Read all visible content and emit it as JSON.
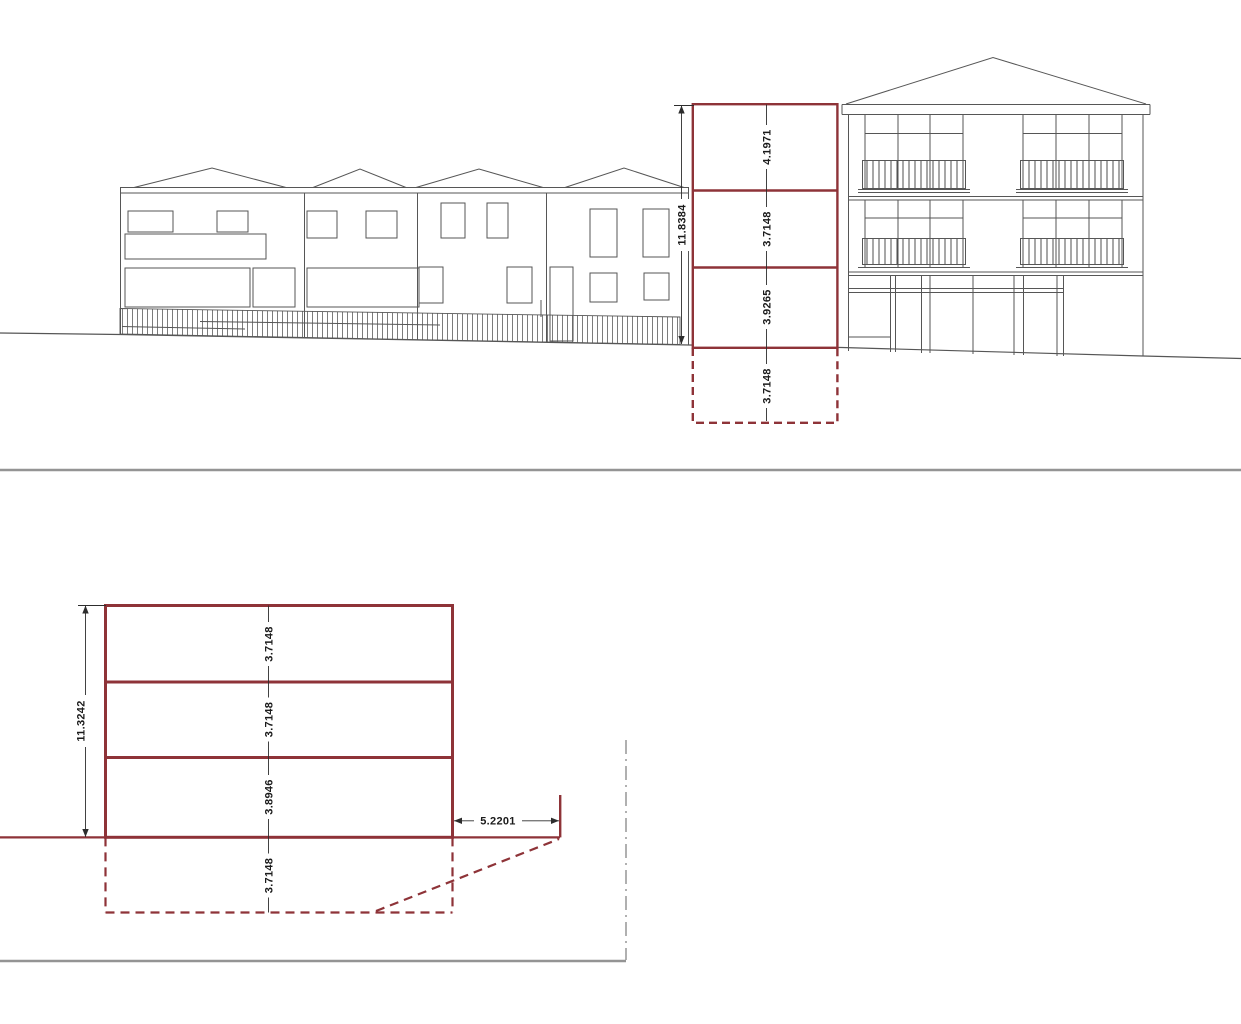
{
  "drawing": {
    "upper_elevation": {
      "description": "street elevation with proposed building outline",
      "total_height": "11.8384",
      "floor_heights": [
        "4.1971",
        "3.7148",
        "3.9265"
      ],
      "basement_height": "3.7148"
    },
    "lower_section": {
      "description": "section through proposed building",
      "total_height": "11.3242",
      "floor_heights": [
        "3.7148",
        "3.7148",
        "3.8946"
      ],
      "basement_height": "3.7148",
      "side_offset": "5.2201"
    },
    "colors": {
      "proposal_outline": "#8e3338",
      "drawing_lines": "#565656",
      "divider": "#949494",
      "dashdot": "#a8a8a8"
    }
  }
}
